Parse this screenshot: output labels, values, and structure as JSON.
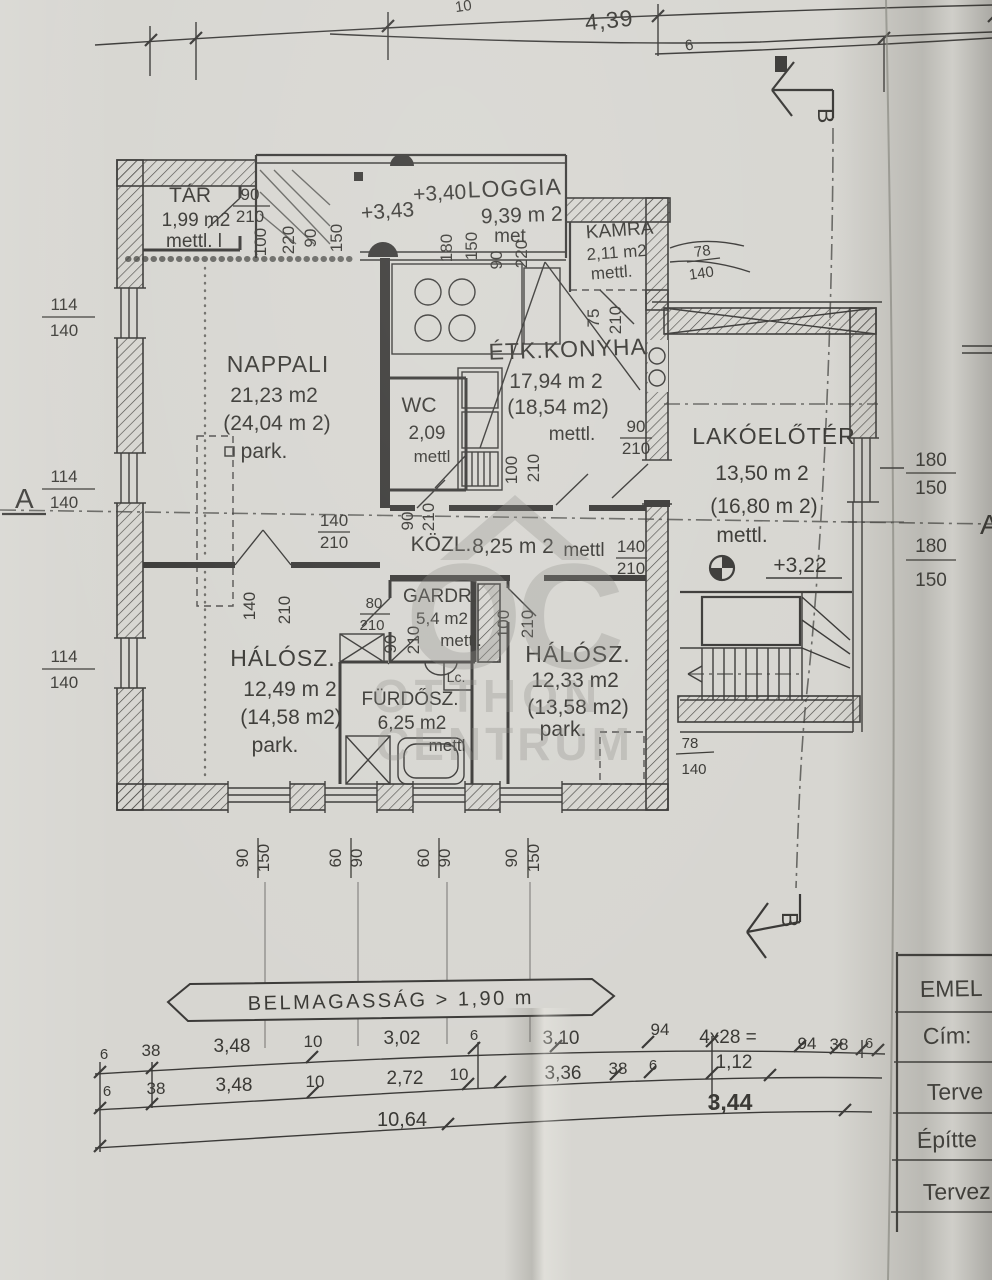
{
  "colors": {
    "paper": "#d7d6d1",
    "ink": "#3b3a38",
    "watermark": "#8a8a84"
  },
  "rooms": [
    {
      "name": "TÁR",
      "area": "1,99 m2",
      "floor": "mettl. l"
    },
    {
      "name": "LOGGIA",
      "area": "9,39 m 2",
      "floor": "met",
      "level": "+3,40"
    },
    {
      "name": "KAMRA",
      "area": "2,11 m2",
      "floor": "mettl."
    },
    {
      "name": "NAPPALI",
      "area": "21,23 m2",
      "area_alt": "(24,04 m 2)",
      "floor": "park."
    },
    {
      "name": "ÉTK.KONYHA",
      "area": "17,94 m 2",
      "area_alt": "(18,54 m2)",
      "floor": "mettl."
    },
    {
      "name": "WC",
      "area": "2,09",
      "floor": "mettl"
    },
    {
      "name": "KÖZL.",
      "area": "8,25 m 2",
      "floor": "mettl"
    },
    {
      "name": "LAKÓELŐTÉR",
      "area": "13,50 m 2",
      "area_alt": "(16,80 m 2)",
      "floor": "mettl.",
      "level": "+3,22"
    },
    {
      "name": "GARDR.",
      "area": "5,4 m2",
      "floor": "mettl."
    },
    {
      "name": "HÁLÓSZ.",
      "area": "12,49 m 2",
      "area_alt": "(14,58 m2)",
      "floor": "park."
    },
    {
      "name": "FÜRDŐSZ.",
      "area": "6,25 m2",
      "floor": "mettl"
    },
    {
      "name": "HÁLÓSZ.",
      "area": "12,33 m2",
      "area_alt": "(13,58 m2)",
      "floor": "park."
    }
  ],
  "levels": {
    "terrace": "+3,43"
  },
  "dim_values": {
    "v6": "6",
    "v10": "10",
    "v38": "38",
    "v60": "60",
    "v75": "75",
    "v78": "78",
    "v80": "80",
    "v90": "90",
    "v94": "94",
    "v100": "100",
    "v114": "114",
    "v140": "140",
    "v150": "150",
    "v180": "180",
    "v210": "210",
    "v220": "220",
    "v272": "2,72",
    "v302": "3,02",
    "v310": "3,10",
    "v336": "3,36",
    "v344": "3,44",
    "v348": "3,48",
    "v439": "4,39",
    "v1064": "10,64",
    "v112": "1,12",
    "v4x28": "4x28 ="
  },
  "labels": {
    "lc": "Lc.",
    "section_a": "A",
    "section_b": "B"
  },
  "banner": {
    "text": "BELMAGASSÁG > 1,90 m"
  },
  "table": {
    "rows": [
      "EMEL",
      "Cím:",
      "Terve",
      "Építte",
      "Tervez"
    ]
  },
  "watermark": {
    "monogram": "OC",
    "line1": "OTTHON",
    "line2": "CENTRUM"
  }
}
